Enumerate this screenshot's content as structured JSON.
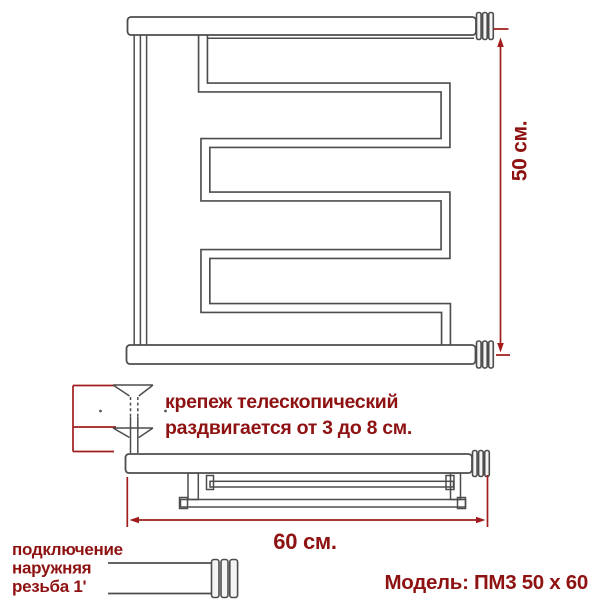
{
  "colors": {
    "line_gray": "#4d4d4d",
    "dimension_red": "#a11c1c",
    "text_red": "#8e1212",
    "background": "#ffffff"
  },
  "front_view": {
    "height_dimension": "50 см."
  },
  "mount_note": {
    "line1": "крепеж телескопический",
    "line2": "раздвигается от 3 до 8 см."
  },
  "side_view": {
    "width_dimension": "60 см."
  },
  "connection_note": {
    "line1": "подключение",
    "line2": "наружняя",
    "line3": "резьба 1'"
  },
  "model": {
    "label": "Модель: ПМ3 50 х 60"
  }
}
